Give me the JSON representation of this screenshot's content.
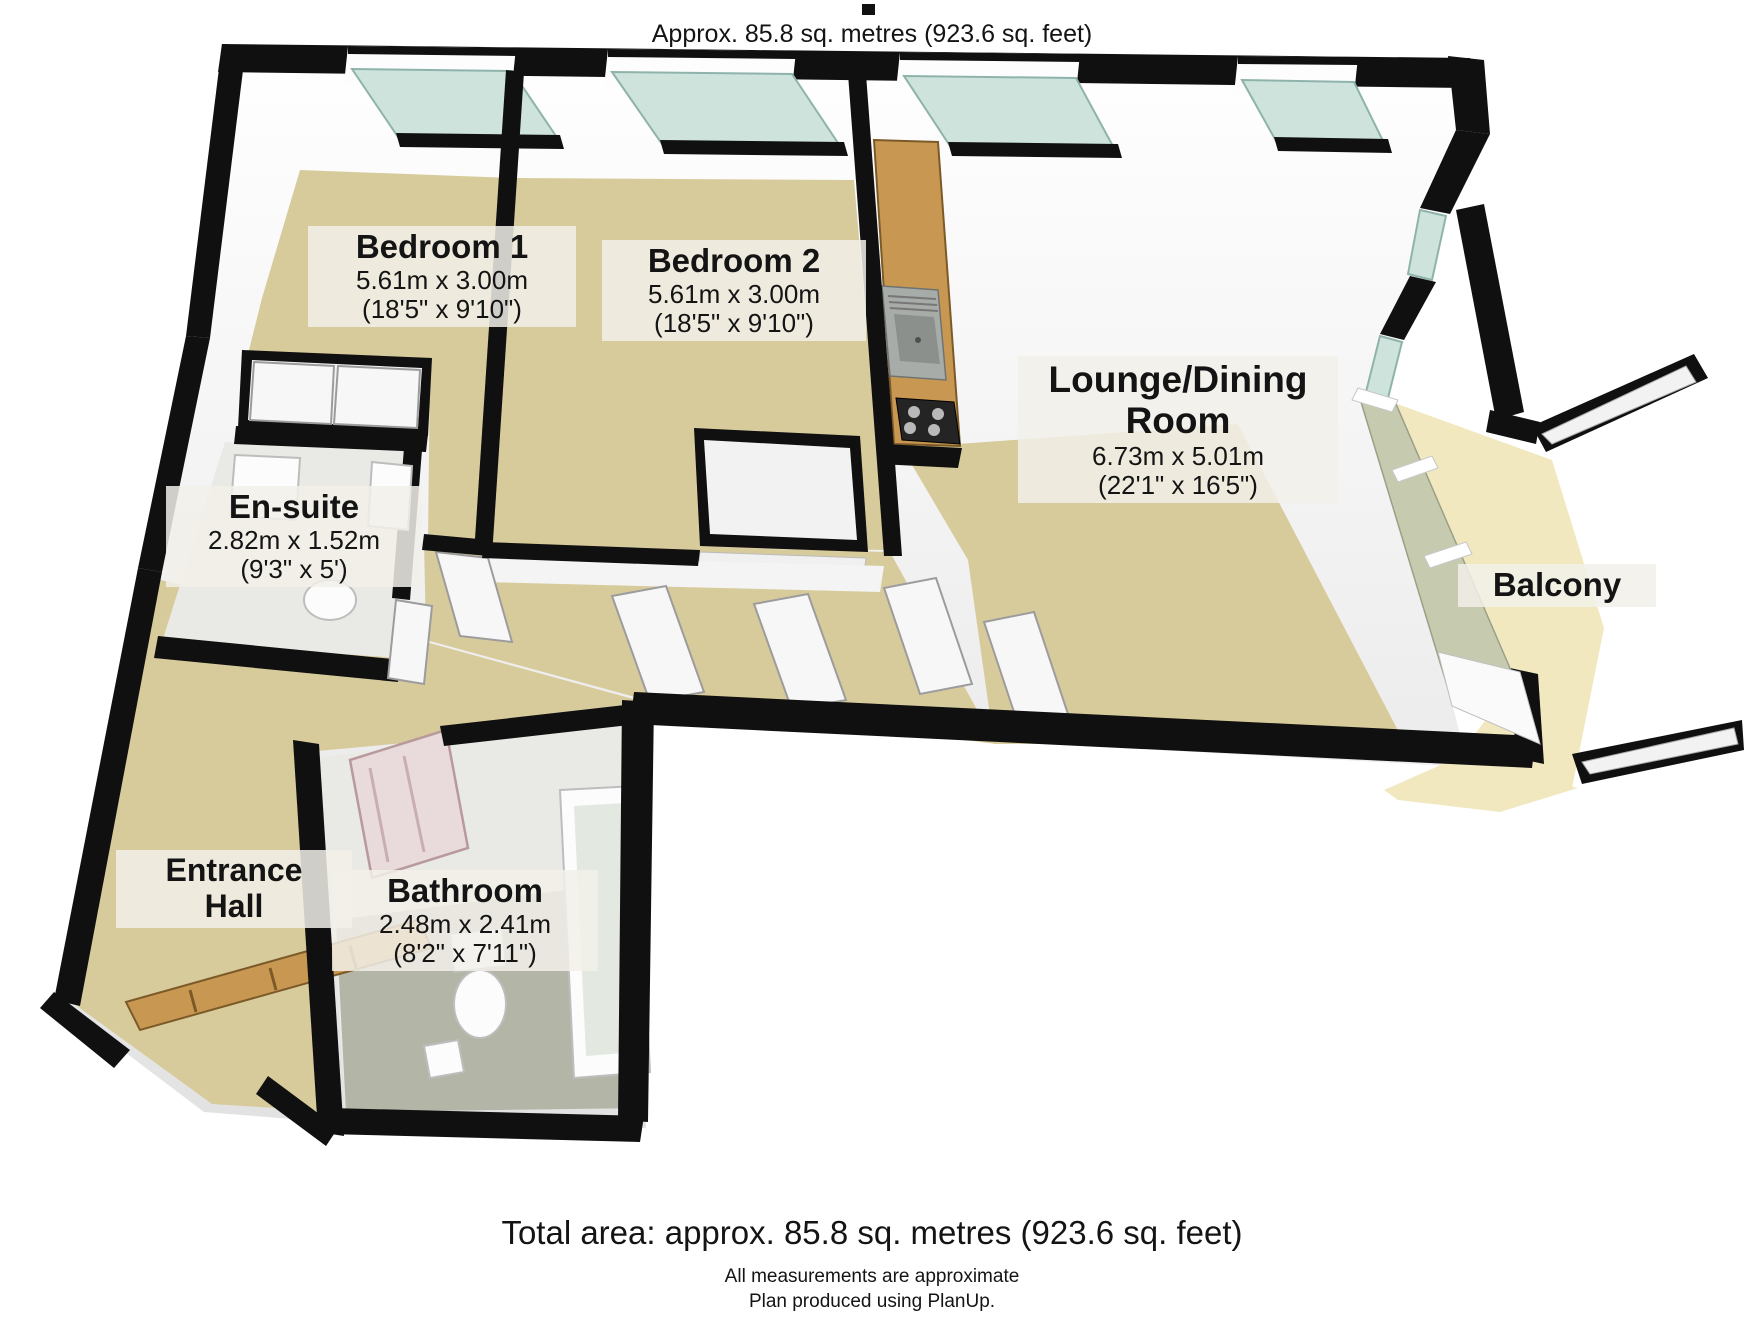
{
  "header": {
    "caption": "Approx. 85.8 sq. metres (923.6 sq. feet)"
  },
  "rooms": {
    "bedroom1": {
      "name": "Bedroom 1",
      "size_metric": "5.61m x 3.00m",
      "size_imperial": "(18'5\" x 9'10\")"
    },
    "bedroom2": {
      "name": "Bedroom 2",
      "size_metric": "5.61m x 3.00m",
      "size_imperial": "(18'5\" x 9'10\")"
    },
    "lounge": {
      "name_line1": "Lounge/Dining",
      "name_line2": "Room",
      "size_metric": "6.73m x 5.01m",
      "size_imperial": "(22'1\" x 16'5\")"
    },
    "ensuite": {
      "name": "En-suite",
      "size_metric": "2.82m x 1.52m",
      "size_imperial": "(9'3\" x 5')"
    },
    "bathroom": {
      "name": "Bathroom",
      "size_metric": "2.48m x 2.41m",
      "size_imperial": "(8'2\" x 7'11\")"
    },
    "entrance": {
      "name_line1": "Entrance",
      "name_line2": "Hall"
    },
    "balcony": {
      "name": "Balcony"
    }
  },
  "footer": {
    "total_area": "Total area: approx. 85.8 sq. metres (923.6 sq. feet)",
    "note1": "All measurements are approximate",
    "note2": "Plan produced using PlanUp."
  },
  "colors": {
    "wall": "#101010",
    "floor": "#d8cb9b",
    "balcony_floor": "#f2e8c0",
    "tile": "#e9e9e5",
    "bath_floor": "#b3b6a6",
    "window_glass": "#cde3dc",
    "balcony_glass": "#c6cbb0",
    "wood": "#c89852",
    "label_bg": "rgba(242,240,233,0.85)",
    "text": "#141414"
  }
}
